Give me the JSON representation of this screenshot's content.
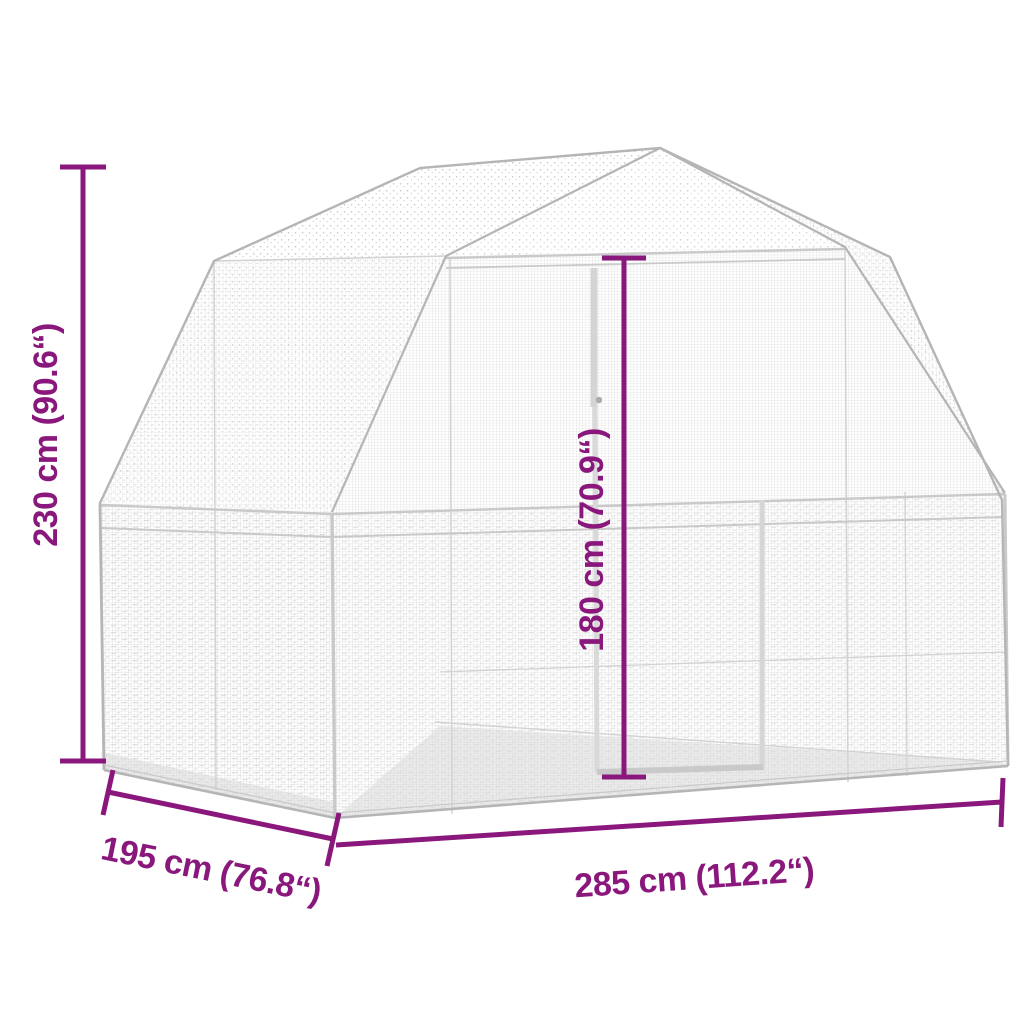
{
  "diagram": {
    "kind": "product-dimension-diagram",
    "subject": "wire-mesh aviary with barn (gambrel) roof and front door",
    "accent_color": "#8a187c",
    "structure": {
      "mesh_color": "#cdcdcd",
      "outline_color": "#b5b5b5",
      "background": "#ffffff"
    },
    "dimensions": [
      {
        "id": "total-height",
        "label": "230 cm (90.6“)",
        "cm": 230,
        "inches": 90.6,
        "placement": "left-vertical"
      },
      {
        "id": "door-height",
        "label": "180 cm (70.9“)",
        "cm": 180,
        "inches": 70.9,
        "placement": "center-vertical"
      },
      {
        "id": "depth",
        "label": "195 cm (76.8“)",
        "cm": 195,
        "inches": 76.8,
        "placement": "bottom-left-diagonal"
      },
      {
        "id": "width",
        "label": "285 cm (112.2“)",
        "cm": 285,
        "inches": 112.2,
        "placement": "bottom-horizontal"
      }
    ]
  }
}
